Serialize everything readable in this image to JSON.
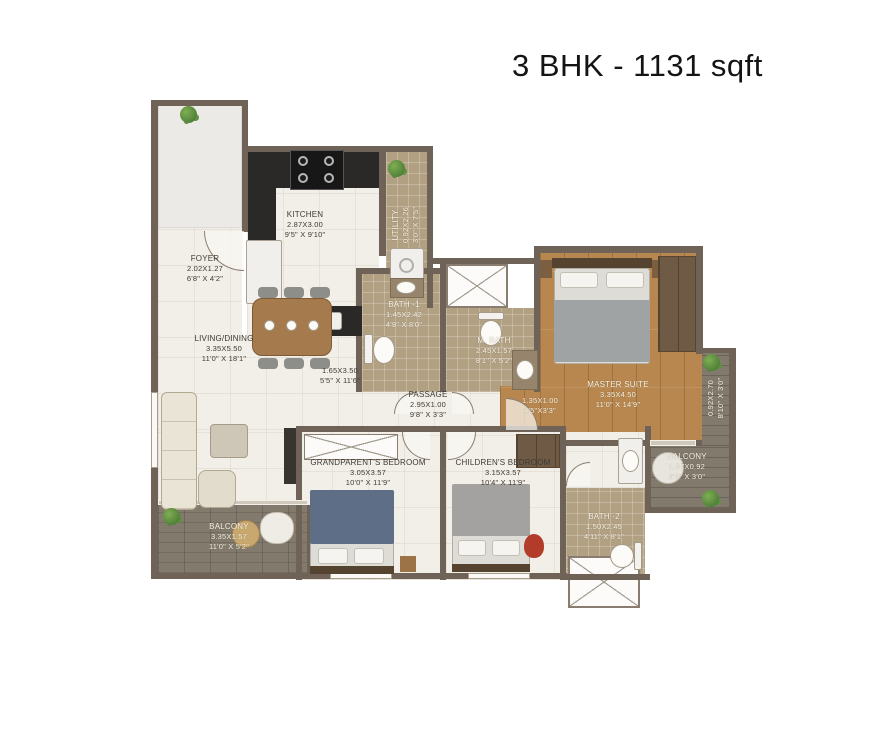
{
  "title": "3 BHK - 1131 sqft",
  "rooms": {
    "kitchen": {
      "name": "KITCHEN",
      "metric": "2.87X3.00",
      "imperial": "9'5\" X 9'10\""
    },
    "utility": {
      "name": "UTILITY",
      "metric": "0.92X2.26",
      "imperial": "3'0\" X 7'5\""
    },
    "foyer": {
      "name": "FOYER",
      "metric": "2.02X1.27",
      "imperial": "6'8\" X 4'2\""
    },
    "living_dining": {
      "name": "LIVING/DINING",
      "metric": "3.35X5.50",
      "imperial": "11'0\" X 18'1\""
    },
    "dining": {
      "metric": "1.65X3.50",
      "imperial": "5'5\" X 11'6\""
    },
    "bath1": {
      "name": "BATH -1",
      "metric": "1.45X2.42",
      "imperial": "4'9\" X 8'0\""
    },
    "m_bath": {
      "name": "M. BATH",
      "metric": "2.45X1.57",
      "imperial": "8'1\" X 5'2\""
    },
    "master_suite": {
      "name": "MASTER SUITE",
      "metric": "3.35X4.50",
      "imperial": "11'0\" X 14'9\""
    },
    "passage": {
      "name": "PASSAGE",
      "metric": "2.95X1.00",
      "imperial": "9'8\" X 3'3\""
    },
    "master_entry": {
      "metric": "1.35X1.00",
      "imperial": "4'5\"X3'3\""
    },
    "grandparents_bedroom": {
      "name": "GRANDPARENT'S BEDROOM",
      "metric": "3.05X3.57",
      "imperial": "10'0\" X 11'9\""
    },
    "childrens_bedroom": {
      "name": "CHILDREN'S BEDROOM",
      "metric": "3.15X3.57",
      "imperial": "10'4\" X 11'9\""
    },
    "balcony_right": {
      "name": "BALCONY",
      "metric": "1.97X0.92",
      "imperial": "6'6\" X 3'0\""
    },
    "bath2": {
      "name": "BATH -2",
      "metric": "1.50X2.45",
      "imperial": "4'11\" X 8'1\""
    },
    "balcony_left": {
      "name": "BALCONY",
      "metric": "3.35X1.57",
      "imperial": "11'0\" X 5'2\""
    },
    "side_ledge": {
      "metric": "0.92X2.70",
      "imperial": "8'10\" X 3'0\""
    }
  },
  "colors": {
    "wall": "#6f6357",
    "floor_light": "#f2efe8",
    "floor_bath": "#b2a083",
    "floor_wood": "#b8874f",
    "floor_deck": "#837a6e",
    "label_dark": "#3e3a33",
    "label_light": "#f7f3e6"
  }
}
